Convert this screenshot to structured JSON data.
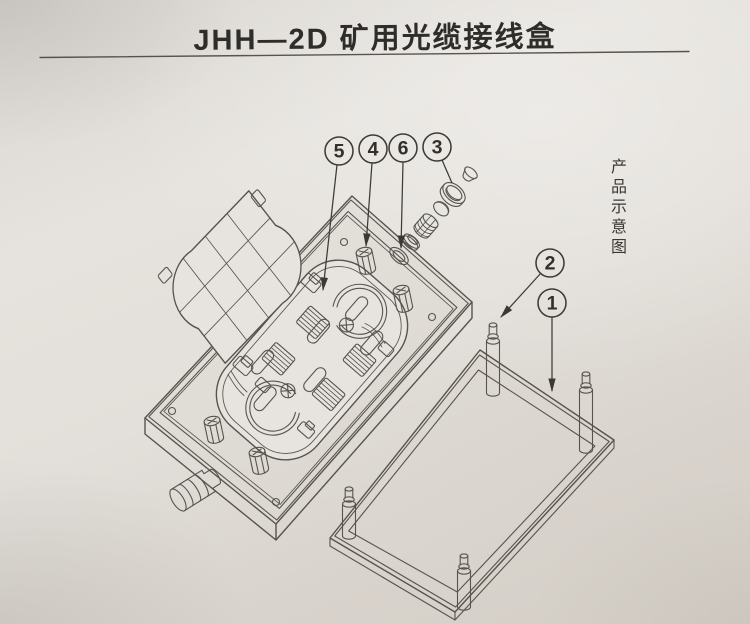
{
  "page": {
    "title": "JHH—2D 矿用光缆接线盒",
    "side_caption": "产品示意图"
  },
  "callouts": [
    {
      "label": "5"
    },
    {
      "label": "4"
    },
    {
      "label": "6"
    },
    {
      "label": "3"
    },
    {
      "label": "2"
    },
    {
      "label": "1"
    }
  ],
  "colors": {
    "paper_light": "#e7e4df",
    "paper_dark": "#d6d1ca",
    "line": "#57534e",
    "ink": "#2f2d2a"
  }
}
